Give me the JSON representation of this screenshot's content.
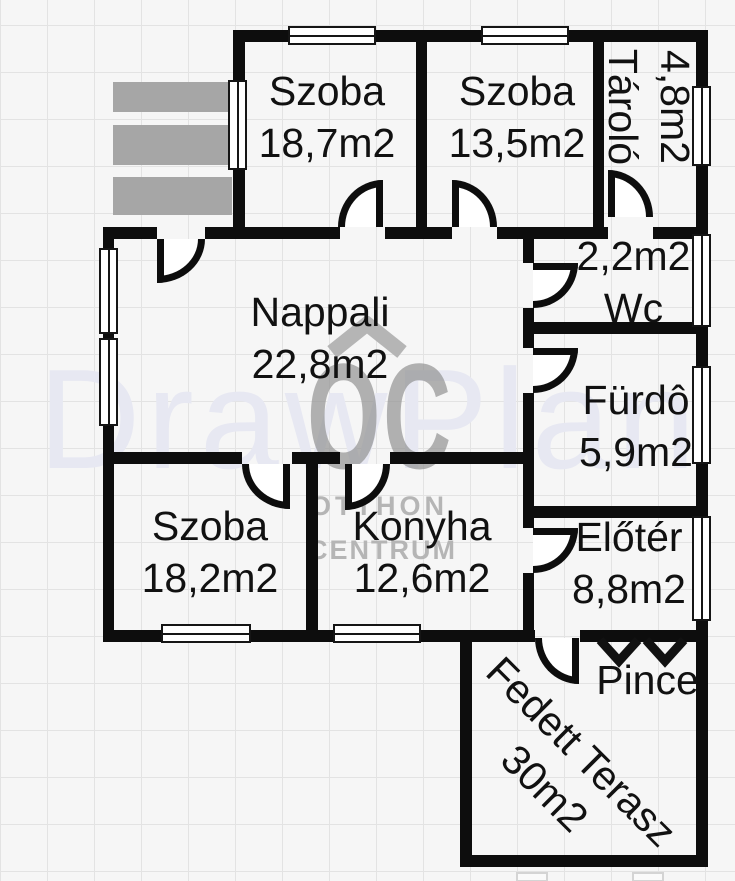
{
  "rooms": {
    "szoba1": {
      "name": "Szoba",
      "area": "18,7m2"
    },
    "szoba2": {
      "name": "Szoba",
      "area": "13,5m2"
    },
    "tarolo": {
      "name": "Tároló",
      "area": "4,8m2"
    },
    "nappali": {
      "name": "Nappali",
      "area": "22,8m2"
    },
    "wc": {
      "name": "Wc",
      "area": "2,2m2"
    },
    "furdo": {
      "name": "Fürdô",
      "area": "5,9m2"
    },
    "szoba3": {
      "name": "Szoba",
      "area": "18,2m2"
    },
    "konyha": {
      "name": "Konyha",
      "area": "12,6m2"
    },
    "eloter": {
      "name": "Előtér",
      "area": "8,8m2"
    },
    "pince": {
      "name": "Pince"
    },
    "terasz": {
      "name": "Fedett Terasz",
      "area": "30m2"
    }
  },
  "watermark": {
    "brand": "DrawPlan",
    "logo_text": "OC",
    "logo_line1": "OTTHON",
    "logo_line2": "CENTRUM"
  },
  "icons": {
    "pince_stairs": "double-chevron-down-icon",
    "logo_roof": "house-roof-icon"
  },
  "colors": {
    "wall": "#0d0d0d",
    "stairs_gray": "#a6a6a6",
    "watermark_light": "#e7e8f2",
    "watermark_gray": "#a9a9a9",
    "grid_line": "#e3e3e3",
    "background": "#f6f6f6"
  }
}
